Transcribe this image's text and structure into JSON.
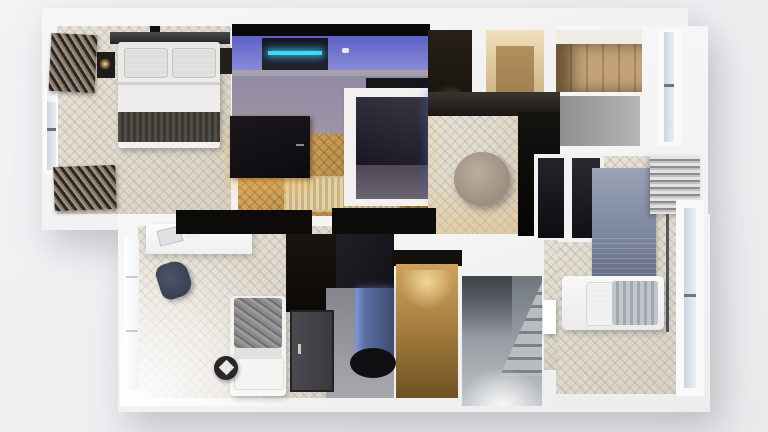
{
  "scene": {
    "title": "3D apartment floor plan render, top-down view",
    "style": "photoreal architectural visualization, cut-away white walls",
    "background_color": "#eff0f2",
    "wall_color": "#f5f5f6",
    "palette": {
      "herringbone_floor_light": "#ddd7cb",
      "herringbone_floor_warm": "#bd8f4a",
      "concrete_floor": "#968ea0",
      "media_room_led": "#3fd6ff",
      "media_room_blue_wall": "#6f73d2",
      "aquarium_blue": "#3a57c4",
      "bathroom_mirror_blue": "#6a7eb0",
      "warm_lamp_glow": "#f0cf8e",
      "dark_furniture": "#121014",
      "rug_blue_gray": "#8792a6",
      "rug_tan": "#d8c191",
      "stair_concrete": "#9ba1a6"
    }
  },
  "rooms": [
    {
      "id": "bedroom-top-left",
      "label": "Master bedroom",
      "floor": "light herringbone wood",
      "furniture": [
        "double bed with white duvet and dark throw",
        "black headboard wall",
        "two nightstands",
        "left window with layered curtains",
        "radiator / curtain stack below window"
      ]
    },
    {
      "id": "media-room-top-center",
      "label": "Media / gaming room",
      "floor": "concrete with purple-blue LED light",
      "furniture": [
        "desk with PC and cyan LED strip",
        "black corner table",
        "black sideboard with warm under-glow"
      ]
    },
    {
      "id": "center-bathroom-core",
      "label": "Central core with aquarium",
      "floor": "dark stone",
      "furniture": [
        "white wall enclosure",
        "blue aquarium strip with fish"
      ]
    },
    {
      "id": "storage-top-right-dark",
      "label": "Dark storage room",
      "floor": "dark",
      "furniture": []
    },
    {
      "id": "entry-warm",
      "label": "Warm-lit entry nook",
      "floor": "wood",
      "furniture": []
    },
    {
      "id": "walk-in-closet",
      "label": "Walk-in closet",
      "floor": "wood",
      "furniture": [
        "wooden wardrobe cabinets"
      ]
    },
    {
      "id": "stair-void-gray",
      "label": "Concrete room / stair void",
      "floor": "concrete",
      "furniture": []
    },
    {
      "id": "hallway-center",
      "label": "Hallway with pouf",
      "floor": "light herringbone wood",
      "furniture": [
        "round taupe pouf",
        "tall black cabinet",
        "tan fringe rug"
      ]
    },
    {
      "id": "bedroom-right",
      "label": "Bedroom right",
      "floor": "light herringbone wood",
      "furniture": [
        "black wardrobe panels",
        "blue-gray rug",
        "bed with gray blanket",
        "white desk bench",
        "right window with striped curtains"
      ]
    },
    {
      "id": "bedroom-bottom-left",
      "label": "Bedroom bottom-left",
      "floor": "light herringbone wood, bright daylight",
      "furniture": [
        "white desk with laptop",
        "dark blue chair",
        "single bed with gray patterned blanket",
        "round black side table",
        "black wardrobe band"
      ]
    },
    {
      "id": "bathroom-bottom",
      "label": "Bathroom",
      "floor": "gray tile",
      "furniture": [
        "dark entry door",
        "blue-lit mirror / shower glass",
        "black oval tub"
      ]
    },
    {
      "id": "corridor-warm-bottom",
      "label": "Warm corridor / closet",
      "floor": "brown wood with lamp glow",
      "furniture": []
    },
    {
      "id": "staircase",
      "label": "Staircase",
      "floor": "gray concrete",
      "furniture": [
        "L-shaped stair run with landing"
      ]
    }
  ],
  "icons": [],
  "text_content": []
}
